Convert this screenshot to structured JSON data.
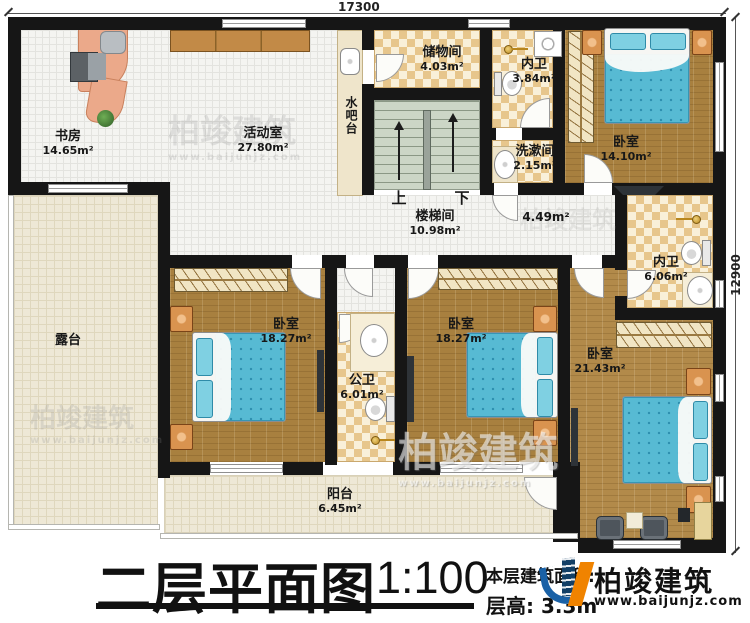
{
  "dimensions": {
    "top": "17300",
    "right": "12900"
  },
  "rooms": {
    "study": {
      "name": "书房",
      "area": "14.65m²"
    },
    "activity": {
      "name": "活动室",
      "area": "27.80m²"
    },
    "waterbar": {
      "name": "水吧台"
    },
    "storage": {
      "name": "储物间",
      "area": "4.03m²"
    },
    "bath_top": {
      "name": "内卫",
      "area": "3.84m²"
    },
    "bedroom_tr": {
      "name": "卧室",
      "area": "14.10m²"
    },
    "washroom": {
      "name": "洗漱间",
      "area": "2.15m²"
    },
    "stairwell": {
      "name": "楼梯间",
      "area": "10.98m²"
    },
    "hallway": {
      "area": "4.49m²"
    },
    "bath_right": {
      "name": "内卫",
      "area": "6.06m²"
    },
    "terrace": {
      "name": "露台"
    },
    "bedroom_bl": {
      "name": "卧室",
      "area": "18.27m²"
    },
    "bath_public": {
      "name": "公卫",
      "area": "6.01m²"
    },
    "bedroom_bm": {
      "name": "卧室",
      "area": "18.27m²"
    },
    "bedroom_br": {
      "name": "卧室",
      "area": "21.43m²"
    },
    "balcony": {
      "name": "阳台",
      "area": "6.45m²"
    }
  },
  "stairs": {
    "up": "上",
    "down": "下"
  },
  "titleblock": {
    "title": "二层平面图",
    "scale": "1:100",
    "area_label": "本层建筑面积:",
    "floor_height": "层高: 3.3m"
  },
  "logo": {
    "name": "柏竣建筑",
    "site": "www.baijunjz.com"
  },
  "watermark": {
    "name": "柏竣建筑",
    "site": "www.baijunjz.com"
  },
  "colors": {
    "wall": "#161616",
    "wood_floor": "#a8803f",
    "checker_tan": "#e7c68c",
    "bed_blue": "#57bad3",
    "stair_green": "#ccd6c6",
    "logo_blue": "#1a61a6",
    "logo_orange": "#f08300"
  }
}
